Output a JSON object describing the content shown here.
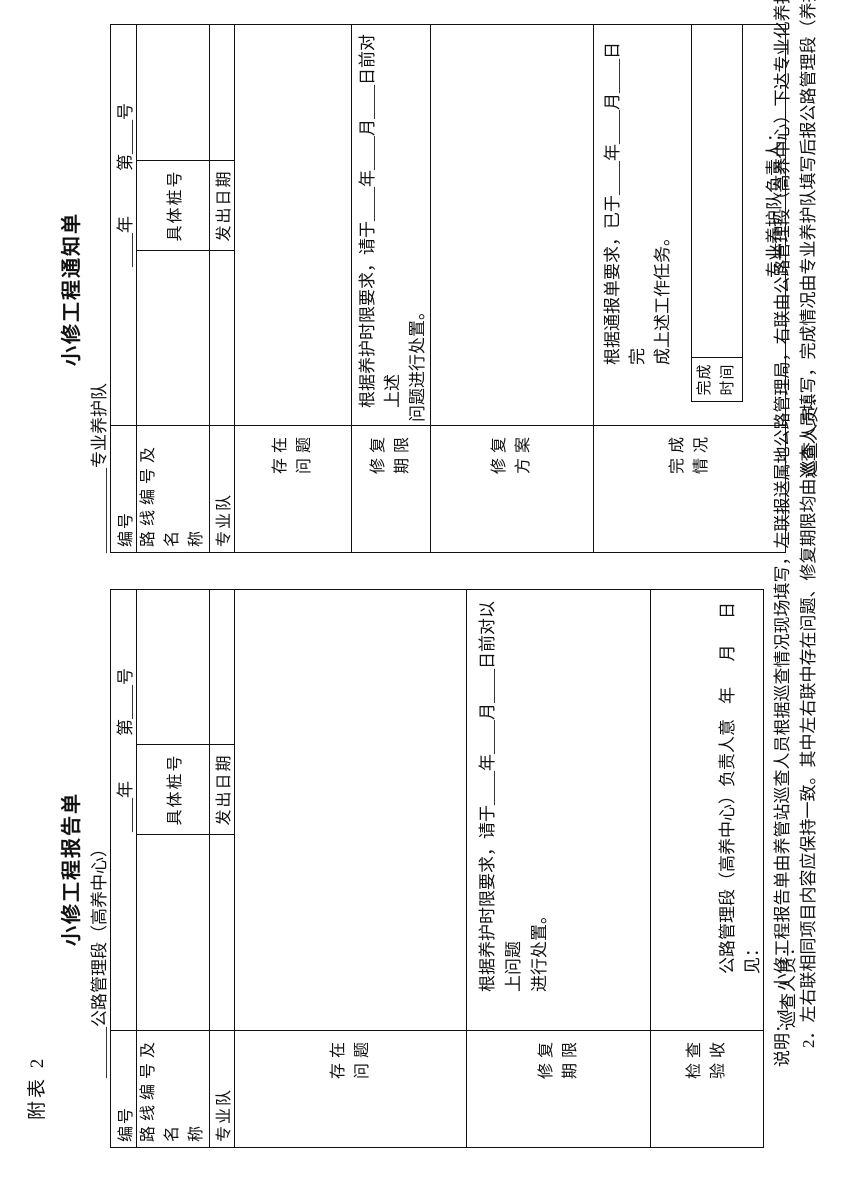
{
  "page": {
    "attachment_tag": "附表 2",
    "background": "#ffffff",
    "ink": "#111111"
  },
  "report_form": {
    "title": "小修工程报告单",
    "header_unit": "______公路管理段（高养中心）",
    "rows": {
      "r1": {
        "label": "编号",
        "value_year": "____年",
        "value_no": "第____号"
      },
      "r2": {
        "label_line1": "路线编号及名",
        "label_line2": "称",
        "mid_label": "具体桩号"
      },
      "r3": {
        "label": "专业队",
        "mid_label": "发出日期"
      },
      "r4": {
        "label_line1": "存在",
        "label_line2": "问题"
      },
      "r5": {
        "label_line1": "修复",
        "label_line2": "期限",
        "text_line1": "根据养护时限要求，请于____年____月____日前对以上问题",
        "text_line2": "进行处置。"
      },
      "r6": {
        "label_line1": "检查",
        "label_line2": "验收",
        "opinion": "公路管理段（高养中心）负责人意见：",
        "date_line": "年      月      日"
      }
    },
    "inspector_line": "巡查人员："
  },
  "notice_form": {
    "title": "小修工程通知单",
    "header_unit": "__________专业养护队",
    "rows": {
      "r1": {
        "label": "编号",
        "value_year": "____年",
        "value_no": "第____号"
      },
      "r2": {
        "label_line1": "路线编号及名",
        "label_line2": "称",
        "mid_label": "具体桩号"
      },
      "r3": {
        "label": "专业队",
        "mid_label": "发出日期"
      },
      "r4": {
        "label_line1": "存在",
        "label_line2": "问题"
      },
      "r5": {
        "label_line1": "修复",
        "label_line2": "期限",
        "text_line1": "根据养护时限要求，请于____年____月____日前对上述",
        "text_line2": "问题进行处置。"
      },
      "r6": {
        "label_line1": "修复",
        "label_line2": "方案"
      },
      "r7": {
        "label_line1": "完成",
        "label_line2": "情况",
        "text_line1": "根据通报单要求，已于____年____月____日完",
        "text_line2": "成上述工作任务。",
        "sub_label_line1": "完成",
        "sub_label_line2": "时间",
        "responsible_line": "专业养护队负责人："
      }
    },
    "inspector_line": "巡查人员："
  },
  "notes": {
    "line1": "说明：1．小修工程报告单由养管站巡查人员根据巡查情况现场填写，左联报送属地公路管理局，右联由公路管理段（高养中心）下达专业化养护队。",
    "line2": "2．左右联相同项目内容应保持一致。其中左右联中存在问题、修复期限均由巡查人员填写，完成情况由专业养护队填写后报公路管理段（养护中心）。"
  }
}
